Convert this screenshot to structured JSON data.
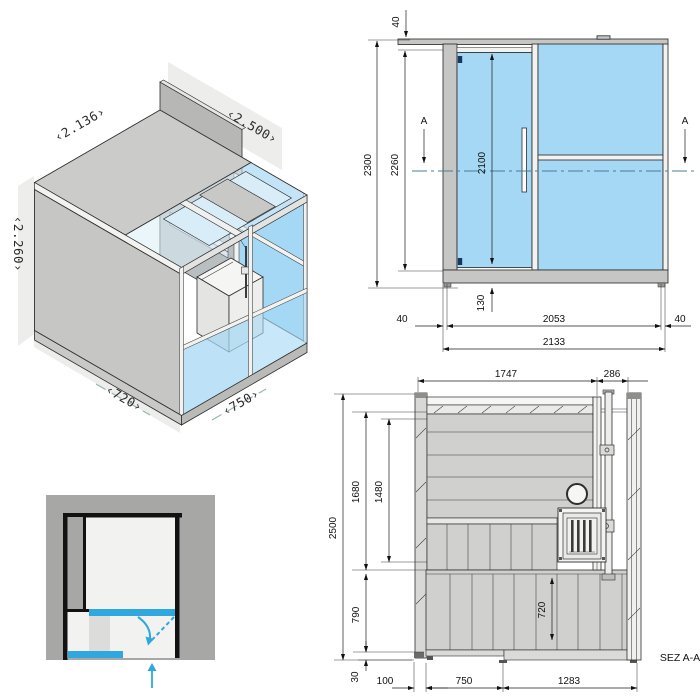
{
  "colors": {
    "glass": "#A5D8F4",
    "accent_blue": "#2FA7DF",
    "wall_gray": "#C6C6C4",
    "panel_gray": "#D0D0CE",
    "line": "#2E2E2E",
    "section_line": "#4A7D96"
  },
  "isometric": {
    "dim_depth": "‹2.136›",
    "dim_width": "‹2.500›",
    "dim_height": "‹2.260›",
    "dim_floor_depth": "‹720›",
    "dim_floor_width": "‹750›"
  },
  "elevation": {
    "marker_left": "A",
    "marker_right": "A",
    "dim_roof_thickness": "40",
    "dim_total_height": "2300",
    "dim_body_height": "2260",
    "dim_door_height": "2100",
    "dim_door_bottom_offset": "130",
    "dim_margin_left": "40",
    "dim_glass_width": "2053",
    "dim_margin_right": "40",
    "dim_total_width": "2133"
  },
  "section": {
    "label": "SEZ A-A",
    "dim_sauna_width": "1747",
    "dim_shower_width": "286",
    "dim_total_height": "2500",
    "dim_interior_height": "1680",
    "dim_paneling_height": "1480",
    "dim_platform_zone_height": "790",
    "dim_platform_height": "720",
    "dim_plinth_height": "30",
    "dim_wall_offset": "100",
    "dim_platform_width": "750",
    "dim_floor_width": "1283"
  }
}
